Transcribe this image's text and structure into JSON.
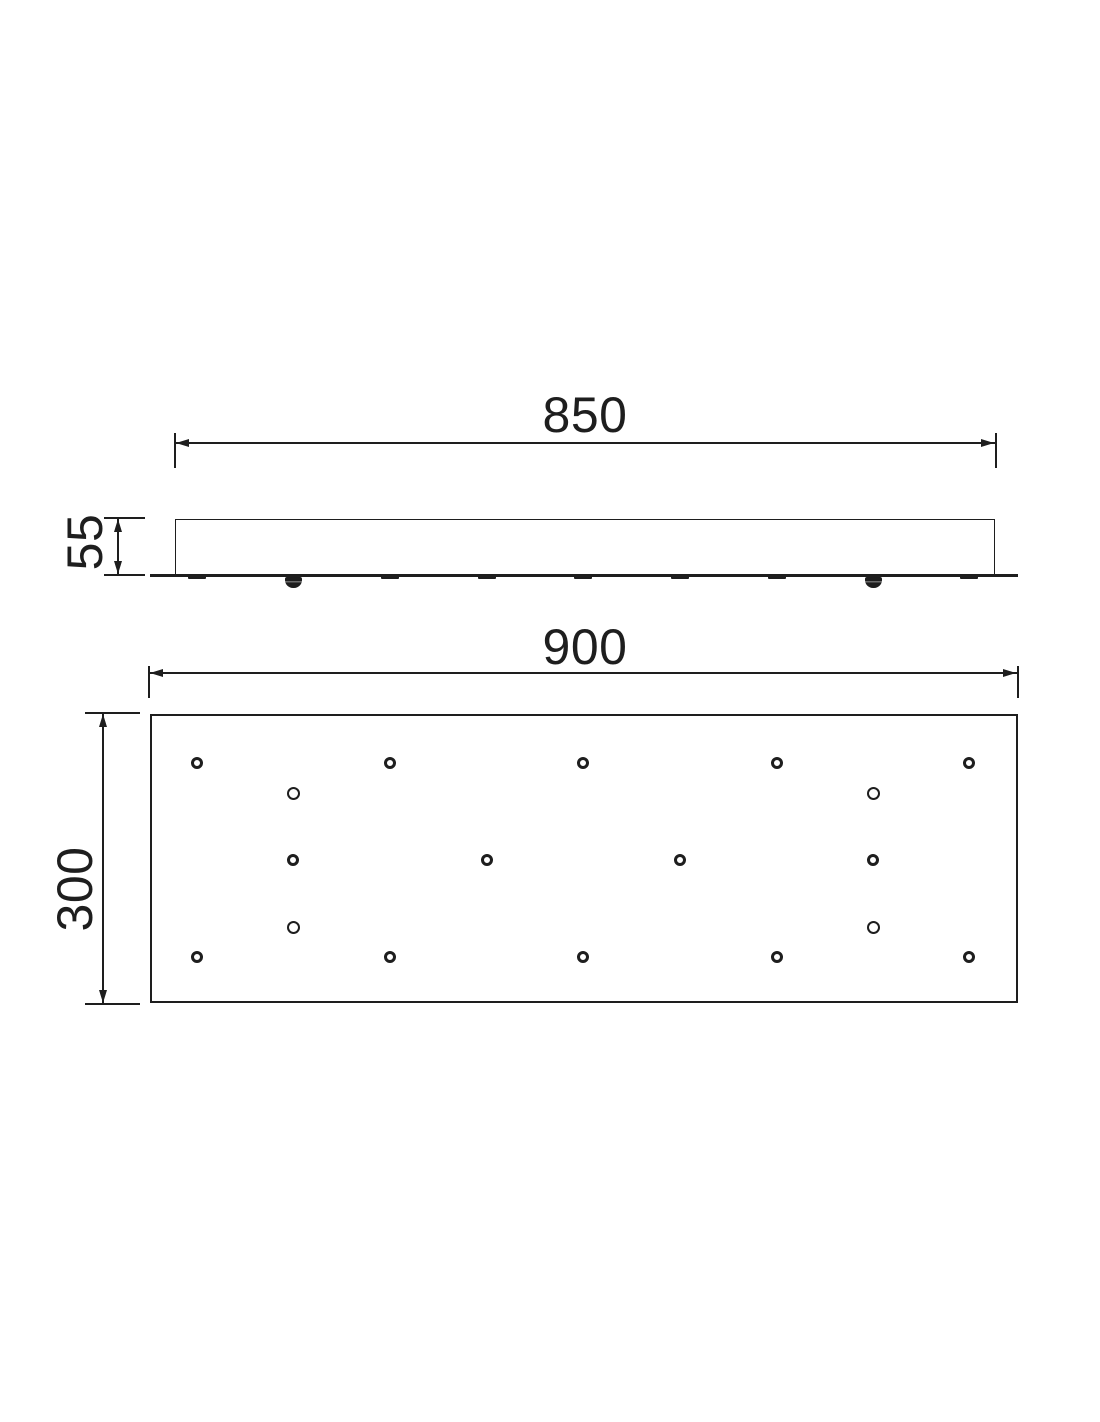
{
  "drawing_type": "technical-drawing-ceiling-canopy-plate",
  "colors": {
    "background": "#ffffff",
    "line": "#1e1e1e"
  },
  "side_view": {
    "body": {
      "x": 175,
      "y": 519,
      "w": 820,
      "h": 56
    },
    "base_plate": {
      "x1": 150,
      "x2": 1018,
      "y": 574,
      "thickness": 3
    },
    "hole_ticks_x": [
      197,
      390,
      487,
      583,
      680,
      777,
      969
    ],
    "screws_x": [
      293,
      873
    ],
    "width_dim": {
      "label": "850",
      "x1": 175,
      "x2": 995,
      "y": 443,
      "ext_top": 433,
      "ext_bottom": 468,
      "label_x": 585,
      "label_y": 415
    },
    "height_dim": {
      "label": "55",
      "x": 118,
      "y1": 519,
      "y2": 574,
      "tick_x1": 104,
      "tick_x2": 145,
      "label_x": 85,
      "label_y": 542
    }
  },
  "plan_view": {
    "rect": {
      "x": 150,
      "y": 714,
      "w": 868,
      "h": 289
    },
    "holes": {
      "ring": [
        {
          "x": 197,
          "y": 763
        },
        {
          "x": 390,
          "y": 763
        },
        {
          "x": 583,
          "y": 763
        },
        {
          "x": 777,
          "y": 763
        },
        {
          "x": 969,
          "y": 763
        },
        {
          "x": 293,
          "y": 860
        },
        {
          "x": 487,
          "y": 860
        },
        {
          "x": 680,
          "y": 860
        },
        {
          "x": 873,
          "y": 860
        },
        {
          "x": 197,
          "y": 957
        },
        {
          "x": 390,
          "y": 957
        },
        {
          "x": 583,
          "y": 957
        },
        {
          "x": 777,
          "y": 957
        },
        {
          "x": 969,
          "y": 957
        }
      ],
      "plain": [
        {
          "x": 293,
          "y": 793
        },
        {
          "x": 873,
          "y": 793
        },
        {
          "x": 293,
          "y": 927
        },
        {
          "x": 873,
          "y": 927
        }
      ]
    },
    "width_dim": {
      "label": "900",
      "x1": 149,
      "x2": 1017,
      "y": 673,
      "ext_top": 666,
      "ext_bottom": 698,
      "label_x": 585,
      "label_y": 647
    },
    "height_dim": {
      "label": "300",
      "x": 103,
      "y1": 714,
      "y2": 1003,
      "tick_x1": 85,
      "tick_x2": 140,
      "label_x": 75,
      "label_y": 889
    }
  }
}
